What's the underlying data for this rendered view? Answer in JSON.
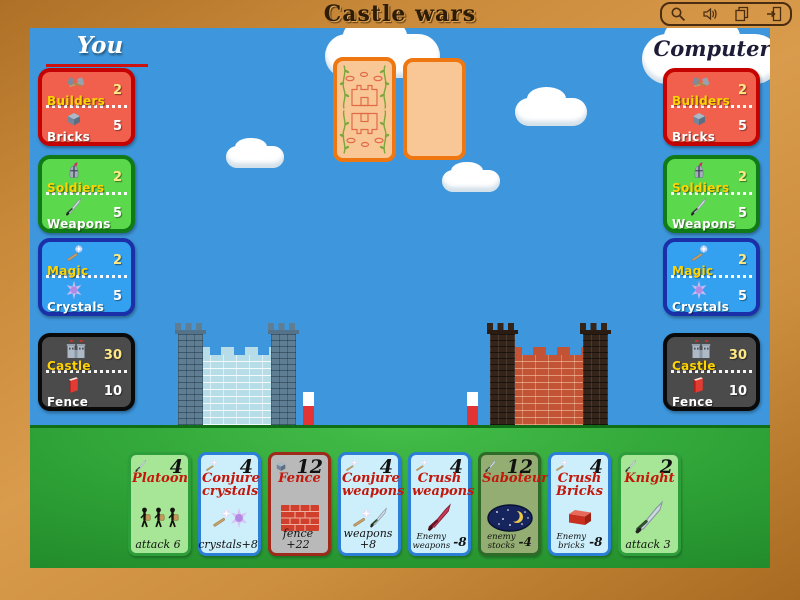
{
  "title": "Castle wars",
  "toolbar": {
    "buttons": [
      {
        "icon": "zoom-icon"
      },
      {
        "icon": "sound-icon"
      },
      {
        "icon": "cards-icon"
      },
      {
        "icon": "exit-icon"
      }
    ]
  },
  "players": {
    "you": {
      "label": "You",
      "panels": [
        {
          "id": "builders",
          "top_label": "Builders",
          "top_value": "2",
          "bottom_label": "Bricks",
          "bottom_value": "5"
        },
        {
          "id": "soldiers",
          "top_label": "Soldiers",
          "top_value": "2",
          "bottom_label": "Weapons",
          "bottom_value": "5"
        },
        {
          "id": "magic",
          "top_label": "Magic",
          "top_value": "2",
          "bottom_label": "Crystals",
          "bottom_value": "5"
        },
        {
          "id": "castle",
          "top_label": "Castle",
          "top_value": "30",
          "bottom_label": "Fence",
          "bottom_value": "10"
        }
      ]
    },
    "computer": {
      "label": "Computer",
      "panels": [
        {
          "id": "builders",
          "top_label": "Builders",
          "top_value": "2",
          "bottom_label": "Bricks",
          "bottom_value": "5"
        },
        {
          "id": "soldiers",
          "top_label": "Soldiers",
          "top_value": "2",
          "bottom_label": "Weapons",
          "bottom_value": "5"
        },
        {
          "id": "magic",
          "top_label": "Magic",
          "top_value": "2",
          "bottom_label": "Crystals",
          "bottom_value": "5"
        },
        {
          "id": "castle",
          "top_label": "Castle",
          "top_value": "30",
          "bottom_label": "Fence",
          "bottom_value": "10"
        }
      ]
    }
  },
  "panel_styles": {
    "builders": {
      "bg": "#f15f4d",
      "border": "#c40202"
    },
    "soldiers": {
      "bg": "#5cd84c",
      "border": "#0f7a16"
    },
    "magic": {
      "bg": "#33a1f0",
      "border": "#1a2fa8"
    },
    "castle": {
      "bg": "#4b4b4b",
      "border": "#0a0a0a"
    }
  },
  "hand": {
    "cards": [
      {
        "name": "Platoon",
        "cost": "4",
        "corner_icon": "sword-icon",
        "art": "soldiers",
        "effect_text": "attack 6",
        "effect_value": "",
        "bg": "#a6e696",
        "border": "#2e9e3a"
      },
      {
        "name": "Conjure crystals",
        "cost": "4",
        "corner_icon": "wand-icon",
        "art": "wand-and-crystal",
        "effect_text": "crystals+8",
        "effect_value": "",
        "bg": "#cdeffb",
        "border": "#2b7fd4"
      },
      {
        "name": "Fence",
        "cost": "12",
        "corner_icon": "brick-icon",
        "art": "brick-wall",
        "effect_text": "fence +22",
        "effect_value": "",
        "bg": "#b9b9b9",
        "border": "#9e2a1a"
      },
      {
        "name": "Conjure weapons",
        "cost": "4",
        "corner_icon": "wand-icon",
        "art": "wand-and-sword",
        "effect_text": "weapons +8",
        "effect_value": "",
        "bg": "#cdeffb",
        "border": "#2b7fd4"
      },
      {
        "name": "Crush weapons",
        "cost": "4",
        "corner_icon": "wand-icon",
        "art": "red-sword",
        "effect_text": "Enemy\nweapons",
        "effect_value": "-8",
        "bg": "#cdeffb",
        "border": "#2b7fd4"
      },
      {
        "name": "Saboteur",
        "cost": "12",
        "corner_icon": "sword-icon",
        "art": "night-moon",
        "effect_text": "enemy\nstocks",
        "effect_value": "-4",
        "bg": "#93ad72",
        "border": "#2e6b28"
      },
      {
        "name": "Crush Bricks",
        "cost": "4",
        "corner_icon": "wand-icon",
        "art": "red-brick",
        "effect_text": "Enemy\nbricks",
        "effect_value": "-8",
        "bg": "#cdeffb",
        "border": "#2b7fd4"
      },
      {
        "name": "Knight",
        "cost": "2",
        "corner_icon": "sword-icon",
        "art": "big-sword",
        "effect_text": "attack 3",
        "effect_value": "",
        "bg": "#a6e696",
        "border": "#2e9e3a"
      }
    ]
  },
  "colors": {
    "sky": "#3e97dd",
    "grass": "#2fa335",
    "frame": "#c98a3e",
    "deck_border": "#ee7711",
    "deck_face": "#f9c795",
    "you_underline": "#cc1111",
    "blue_castle_wall": "#b7dde8",
    "red_castle_wall": "#c25335"
  }
}
